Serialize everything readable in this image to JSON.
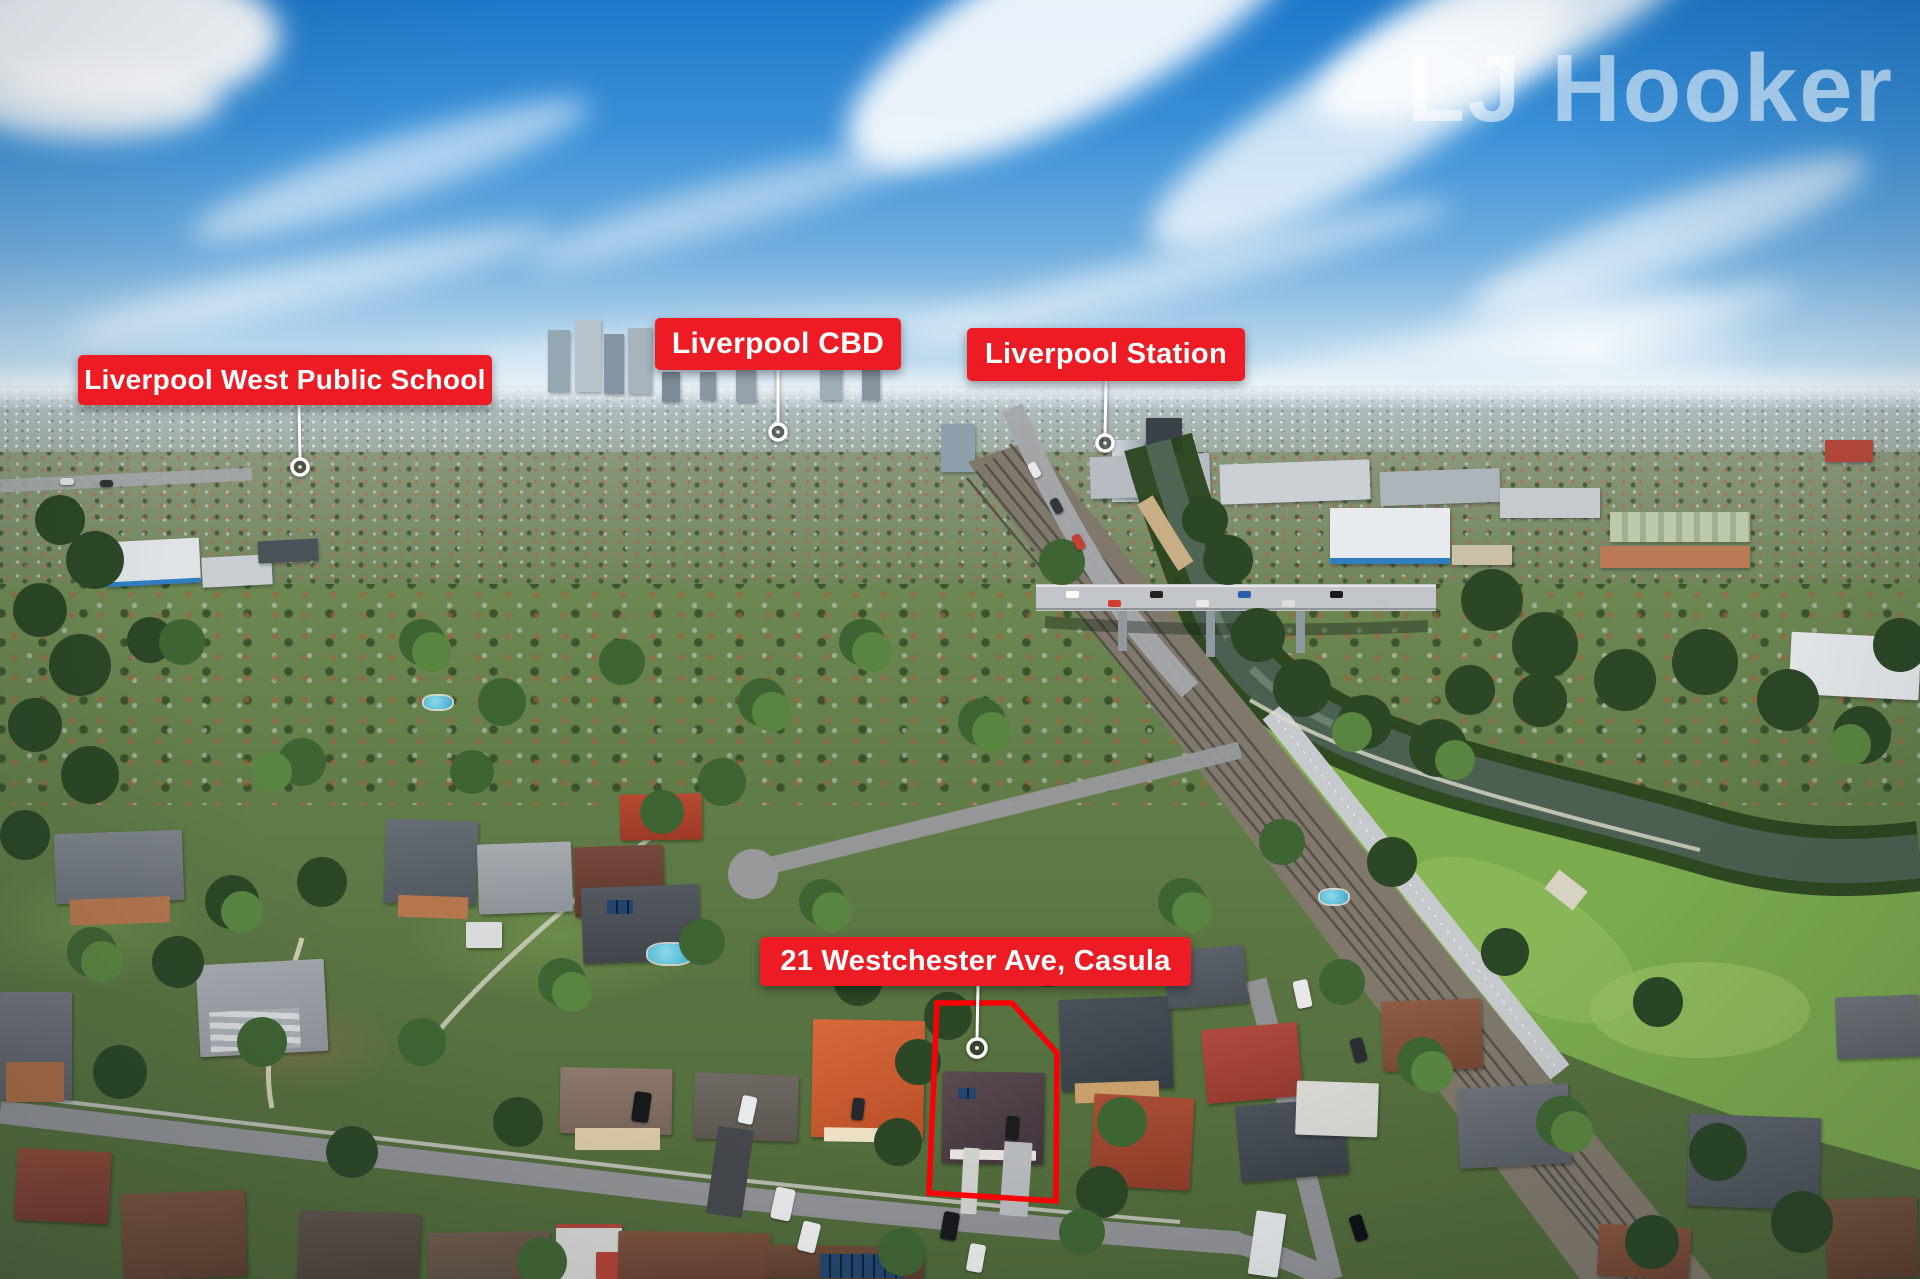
{
  "watermark": {
    "text": "LJ Hooker"
  },
  "annotations": {
    "school": {
      "text": "Liverpool West Public School"
    },
    "cbd": {
      "text": "Liverpool CBD"
    },
    "station": {
      "text": "Liverpool Station"
    },
    "property": {
      "text": "21 Westchester Ave, Casula"
    }
  },
  "icons": {
    "location_marker": "white-ring-circle"
  },
  "theme": {
    "label_background": "#ED1B24",
    "label_text_color": "#FFFFFF",
    "property_outline_color": "#FB0007",
    "leader_line_color": "#FFFFFF",
    "watermark_color": "rgba(255,255,255,0.55)"
  }
}
